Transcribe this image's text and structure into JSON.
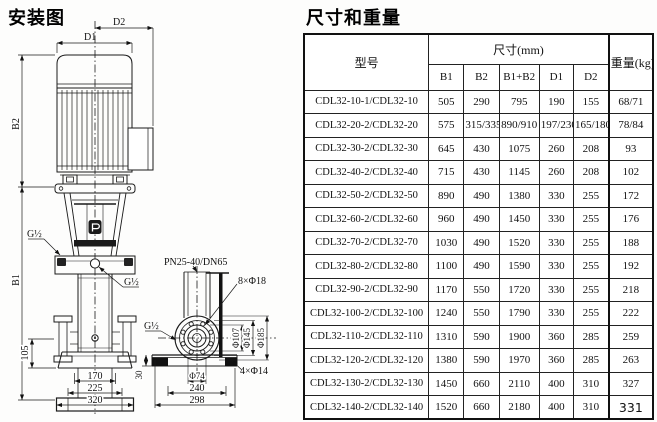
{
  "titles": {
    "left": "安装图",
    "right": "尺寸和重量"
  },
  "drawing": {
    "labels": {
      "d1": "D1",
      "d2": "D2",
      "b1": "B1",
      "b2": "B2",
      "g_half_fill": "G½",
      "g_half_center": "G½",
      "g_half_side": "G½",
      "flange_spec": "PN25-40/DN65",
      "bolt_circle_8": "8×Φ18",
      "bolt_holes_4": "4×Φ14",
      "dia107": "Φ107",
      "dia145": "Φ145",
      "dia185": "Φ185",
      "dia74": "Φ74",
      "dim105": "105",
      "dim30": "30",
      "dim170": "170",
      "dim225": "225",
      "dim320": "320",
      "dim240": "240",
      "dim298": "298"
    }
  },
  "table": {
    "col_model": "型号",
    "col_size": "尺寸(mm)",
    "col_weight": "重量(kg)",
    "sub_cols": [
      "B1",
      "B2",
      "B1+B2",
      "D1",
      "D2"
    ],
    "rows": [
      {
        "model": "CDL32-10-1/CDL32-10",
        "b1": "505",
        "b2": "290",
        "b1b2": "795",
        "d1": "190",
        "d2": "155",
        "wt": "68/71"
      },
      {
        "model": "CDL32-20-2/CDL32-20",
        "b1": "575",
        "b2": "315/335",
        "b1b2": "890/910",
        "d1": "197/230",
        "d2": "165/180",
        "wt": "78/84"
      },
      {
        "model": "CDL32-30-2/CDL32-30",
        "b1": "645",
        "b2": "430",
        "b1b2": "1075",
        "d1": "260",
        "d2": "208",
        "wt": "93"
      },
      {
        "model": "CDL32-40-2/CDL32-40",
        "b1": "715",
        "b2": "430",
        "b1b2": "1145",
        "d1": "260",
        "d2": "208",
        "wt": "102"
      },
      {
        "model": "CDL32-50-2/CDL32-50",
        "b1": "890",
        "b2": "490",
        "b1b2": "1380",
        "d1": "330",
        "d2": "255",
        "wt": "172"
      },
      {
        "model": "CDL32-60-2/CDL32-60",
        "b1": "960",
        "b2": "490",
        "b1b2": "1450",
        "d1": "330",
        "d2": "255",
        "wt": "176"
      },
      {
        "model": "CDL32-70-2/CDL32-70",
        "b1": "1030",
        "b2": "490",
        "b1b2": "1520",
        "d1": "330",
        "d2": "255",
        "wt": "188"
      },
      {
        "model": "CDL32-80-2/CDL32-80",
        "b1": "1100",
        "b2": "490",
        "b1b2": "1590",
        "d1": "330",
        "d2": "255",
        "wt": "192"
      },
      {
        "model": "CDL32-90-2/CDL32-90",
        "b1": "1170",
        "b2": "550",
        "b1b2": "1720",
        "d1": "330",
        "d2": "255",
        "wt": "218"
      },
      {
        "model": "CDL32-100-2/CDL32-100",
        "b1": "1240",
        "b2": "550",
        "b1b2": "1790",
        "d1": "330",
        "d2": "255",
        "wt": "222"
      },
      {
        "model": "CDL32-110-2/CDL32-110",
        "b1": "1310",
        "b2": "590",
        "b1b2": "1900",
        "d1": "360",
        "d2": "285",
        "wt": "259"
      },
      {
        "model": "CDL32-120-2/CDL32-120",
        "b1": "1380",
        "b2": "590",
        "b1b2": "1970",
        "d1": "360",
        "d2": "285",
        "wt": "263"
      },
      {
        "model": "CDL32-130-2/CDL32-130",
        "b1": "1450",
        "b2": "660",
        "b1b2": "2110",
        "d1": "400",
        "d2": "310",
        "wt": "327"
      },
      {
        "model": "CDL32-140-2/CDL32-140",
        "b1": "1520",
        "b2": "660",
        "b1b2": "2180",
        "d1": "400",
        "d2": "310",
        "wt": "331"
      }
    ]
  }
}
